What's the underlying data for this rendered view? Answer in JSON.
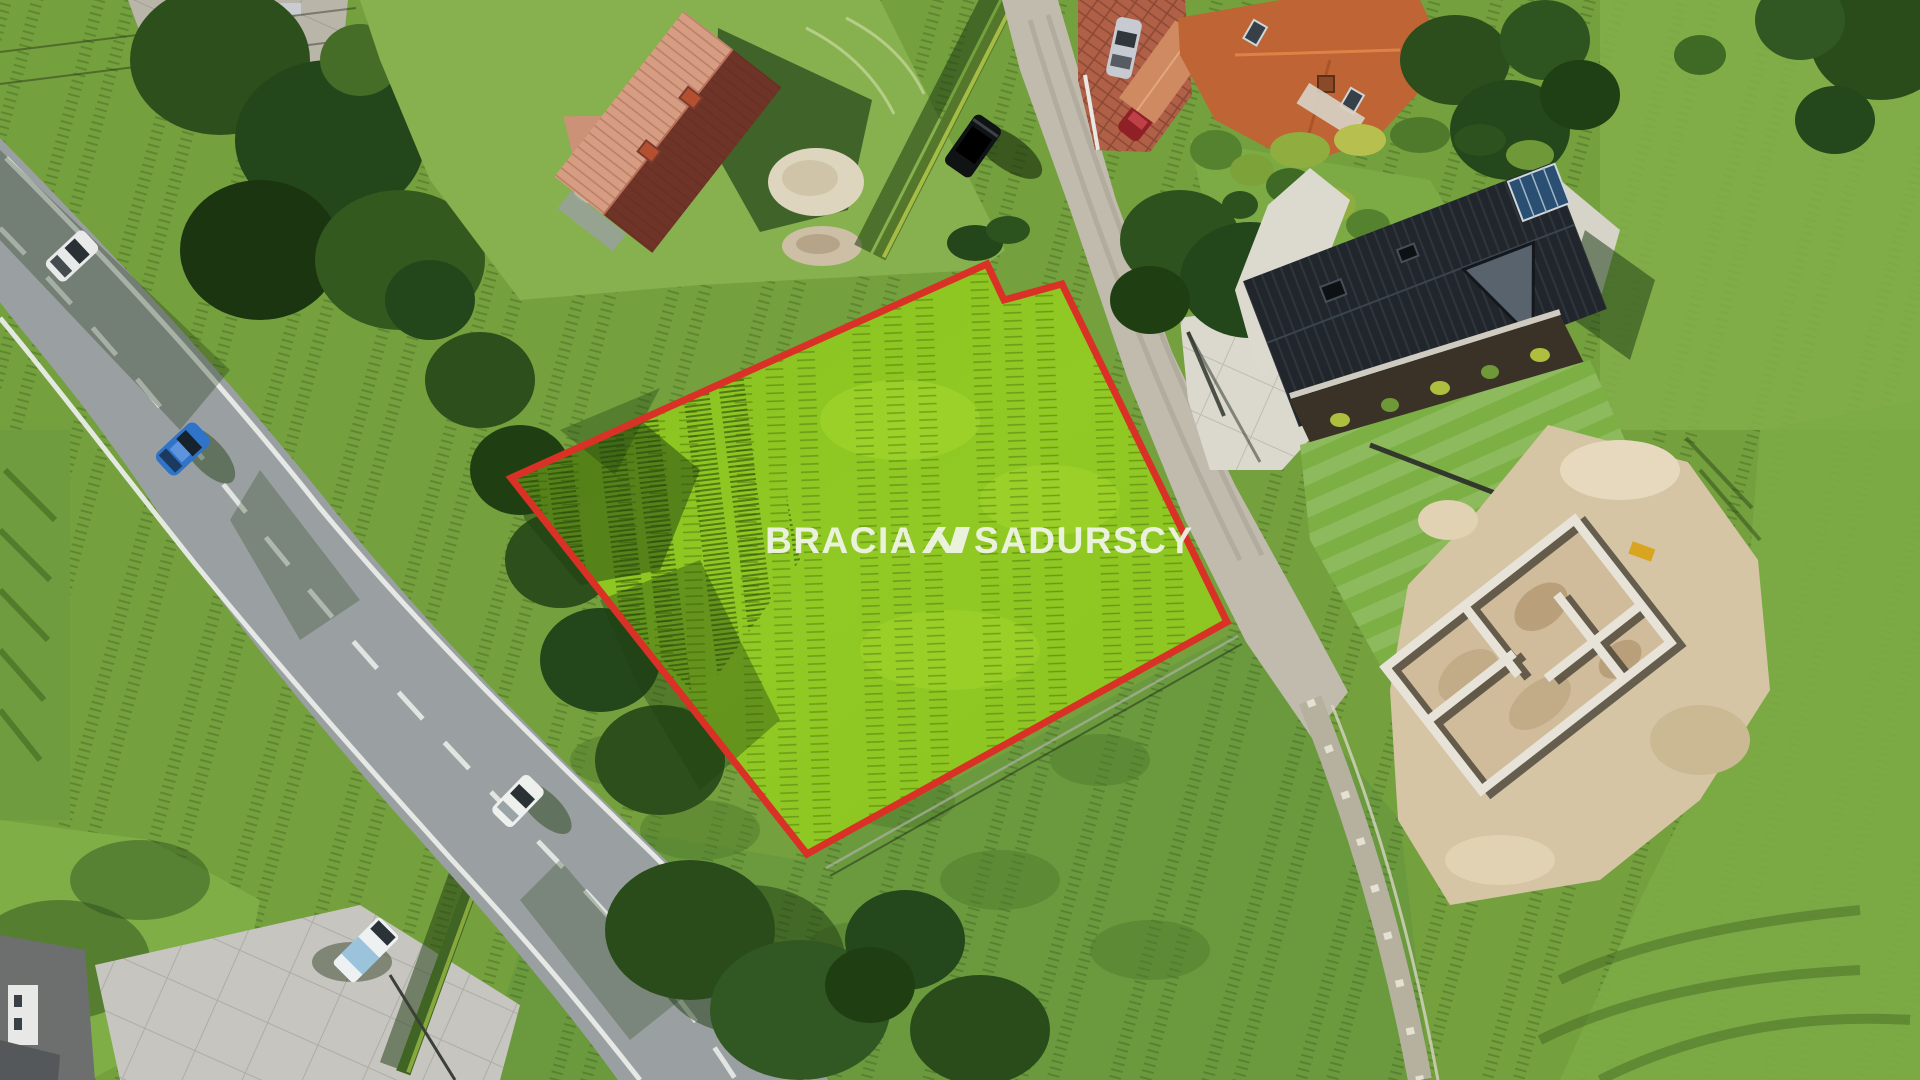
{
  "watermark": {
    "left": "BRACIA",
    "right": "SADURSCY"
  },
  "colors": {
    "grass_base": "#74a03e",
    "road_asphalt": "#9aa0a1",
    "road_marking": "#e9ece9",
    "gravel_road": "#c0bbac",
    "concrete": "#dbd8ce",
    "brick": "#b06046",
    "plot_fill": "#8ec723",
    "plot_outline": "#d93125",
    "light_roof": "#d69d83",
    "dark_roof": "#20262c",
    "orange_roof": "#bf6434",
    "sand": "#d6c5a4",
    "watermark_text": "#f5f7f0"
  }
}
